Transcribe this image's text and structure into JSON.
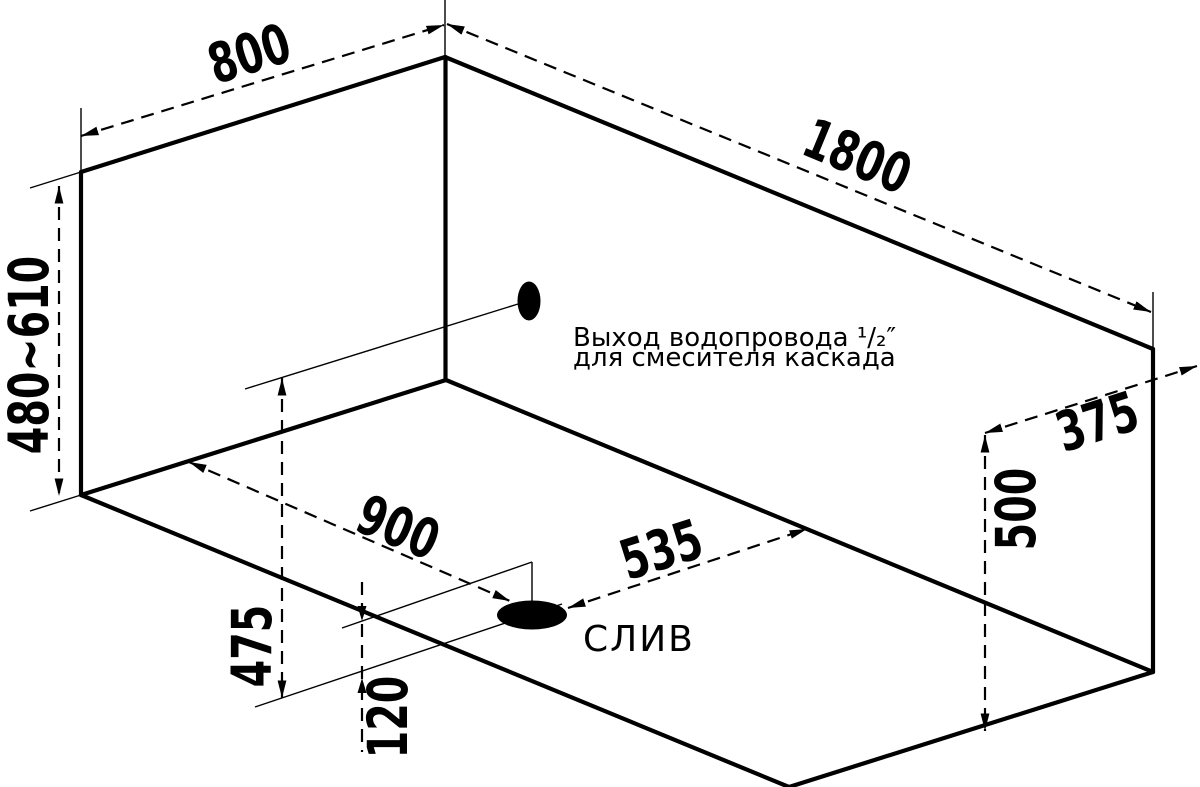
{
  "drawing": {
    "dims": {
      "width": "800",
      "length": "1800",
      "height_range": "480~610",
      "side_offset": "375",
      "side_height": "500",
      "drain_length_pos": "900",
      "drain_right_dist": "535",
      "outlet_drop": "475",
      "drain_offset": "120"
    },
    "labels": {
      "drain": "СЛИВ",
      "outlet_line1": "Выход водопровода ¹/₂″",
      "outlet_line2": "для смесителя каскада"
    },
    "colors": {
      "ink": "#000000",
      "paper": "#ffffff"
    }
  }
}
